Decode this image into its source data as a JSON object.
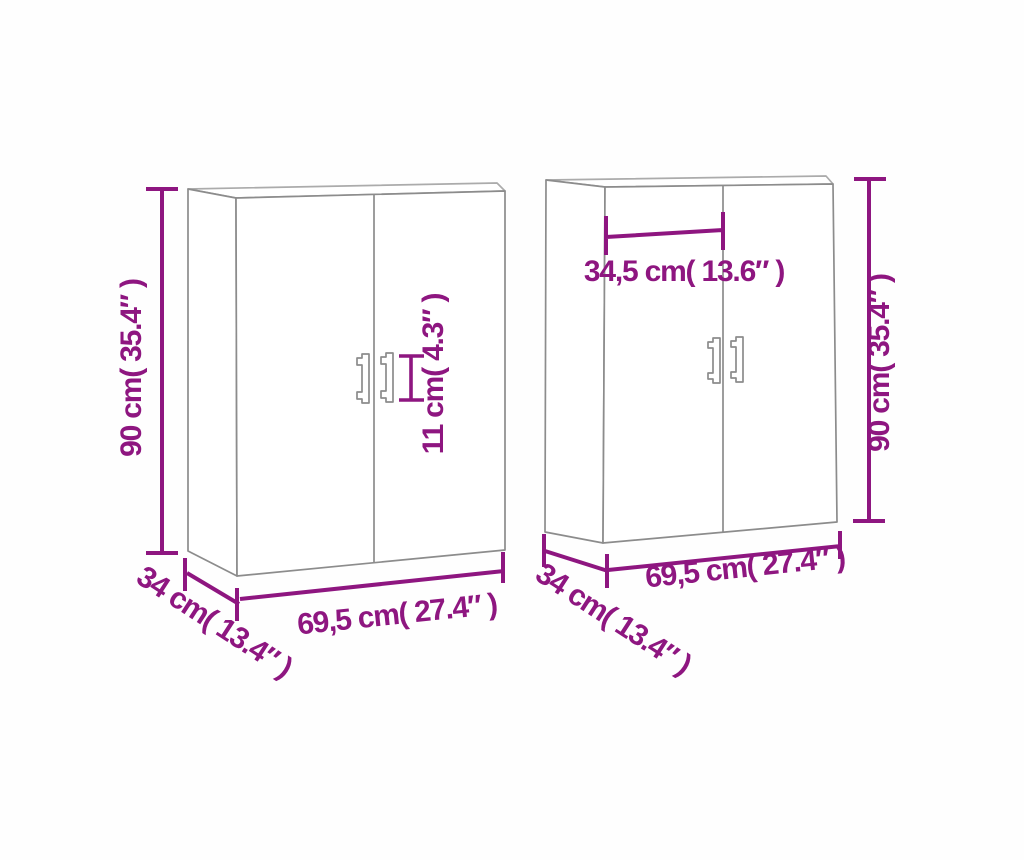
{
  "diagram": {
    "type": "product-dimension-diagram",
    "subject": "two wall cabinets",
    "background_color": "#fefefe",
    "accent_color": "#8e1680",
    "line_color": "#8c8c8c",
    "cabinets": [
      {
        "name": "left-cabinet",
        "doors": 2,
        "dimensions": {
          "height": "90 cm( 35.4″ )",
          "width": "69,5 cm( 27.4″ )",
          "depth": "34 cm( 13.4″ )",
          "handle_height": "11 cm( 4.3″ )"
        }
      },
      {
        "name": "right-cabinet",
        "doors": 2,
        "dimensions": {
          "height": "90 cm( 35.4″ )",
          "width": "69,5 cm( 27.4″ )",
          "depth": "34 cm( 13.4″ )",
          "door_width": "34,5 cm( 13.6″ )"
        }
      }
    ]
  }
}
